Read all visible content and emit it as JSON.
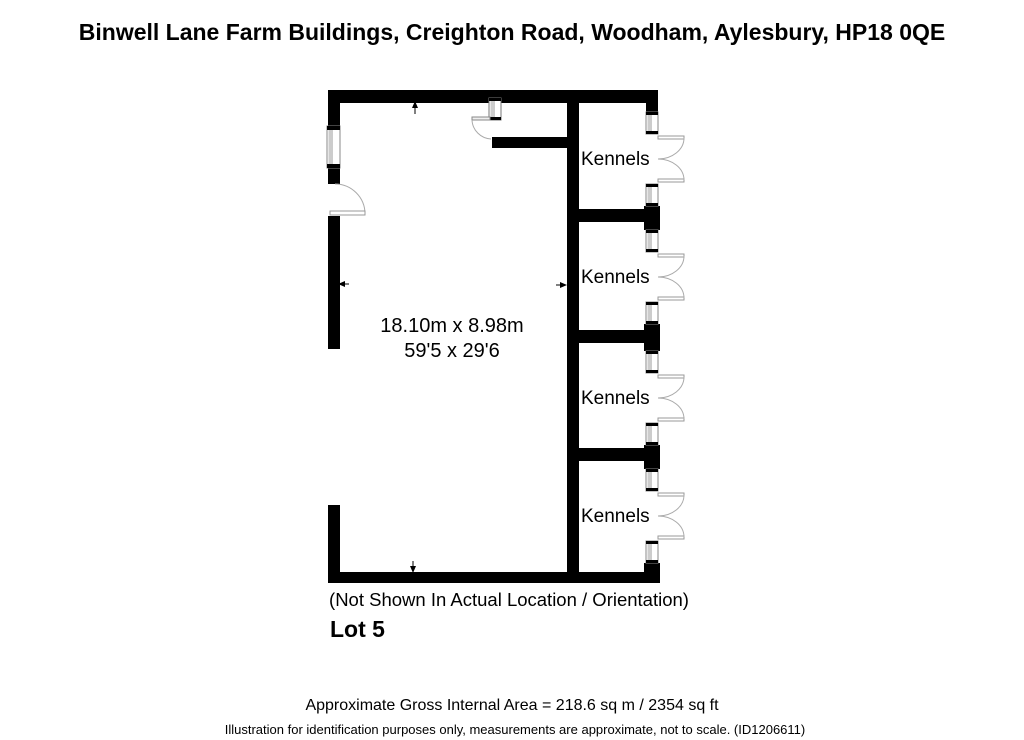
{
  "title": "Binwell Lane Farm Buildings, Creighton Road, Woodham, Aylesbury, HP18 0QE",
  "plan": {
    "room": {
      "dimensions_metric": "18.10m x 8.98m",
      "dimensions_imperial": "59'5 x 29'6"
    },
    "kennels": [
      {
        "label": "Kennels"
      },
      {
        "label": "Kennels"
      },
      {
        "label": "Kennels"
      },
      {
        "label": "Kennels"
      }
    ],
    "caption": "(Not Shown In Actual Location / Orientation)",
    "lot_label": "Lot 5"
  },
  "footer": {
    "area_line": "Approximate Gross Internal Area = 218.6 sq m / 2354 sq ft",
    "disclaimer": "Illustration for identification purposes only, measurements are approximate, not to scale. (ID1206611)"
  },
  "colors": {
    "wall": "#000000",
    "symbol_stroke": "#999999",
    "background": "#ffffff"
  }
}
